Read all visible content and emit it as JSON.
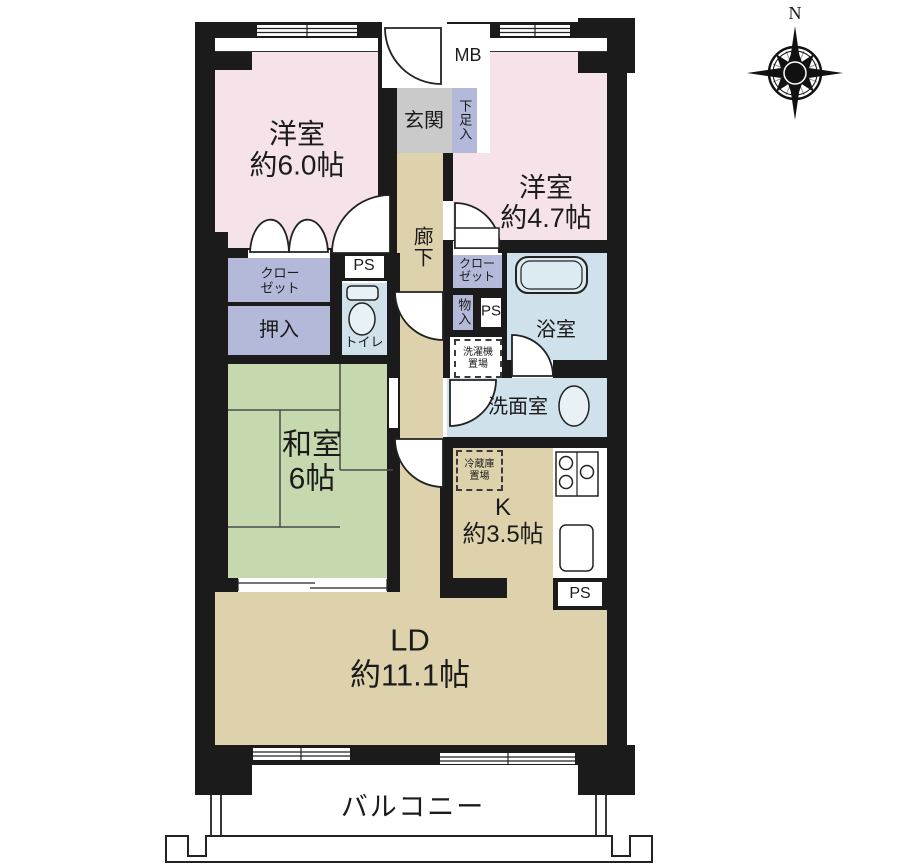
{
  "compass": {
    "north": "N"
  },
  "rooms": {
    "western6": {
      "name": "洋室",
      "size": "約6.0帖"
    },
    "western47": {
      "name": "洋室",
      "size": "約4.7帖"
    },
    "japanese": {
      "name": "和室",
      "size": "6帖"
    },
    "living": {
      "name": "LD",
      "size": "約11.1帖"
    },
    "kitchen": {
      "name": "K",
      "size": "約3.5帖"
    },
    "entrance": "玄関",
    "hallway": "廊下",
    "bathroom": "浴室",
    "washroom": "洗面室",
    "toilet": "トイレ",
    "balcony": "バルコニー"
  },
  "labels": {
    "meter_box": "MB",
    "shoe_box": "下足入",
    "pipe_space": "PS",
    "closet_line1": "クロー",
    "closet_line2": "ゼット",
    "oshiire": "押入",
    "storage": "物入",
    "washer_line1": "洗濯機",
    "washer_line2": "置場",
    "fridge_line1": "冷蔵庫",
    "fridge_line2": "置場"
  },
  "colors": {
    "wall": "#1b1b1b",
    "western_room": "#f6e3ea",
    "tatami_room": "#c6d8ae",
    "wood_floor": "#ded2ad",
    "wet_area": "#cfe1ea",
    "fixture": "#e8f1f6",
    "storage": "#b4b9d9",
    "entrance": "#cacaca"
  }
}
